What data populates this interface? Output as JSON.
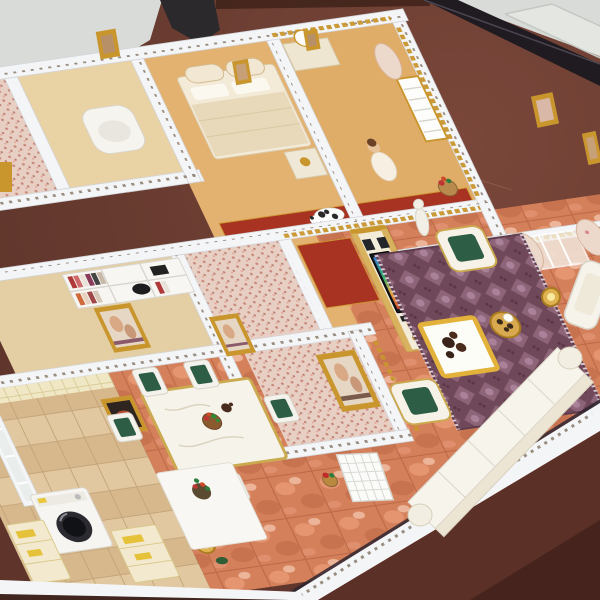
{
  "scene": {
    "subject": "Photograph of a miniature dollhouse apartment model with open-top rooms, standing on a dark reddish-brown table",
    "rooms": [
      "bathroom",
      "left-closet",
      "main-bedroom",
      "doll-bedroom",
      "study",
      "gallery-room-pink",
      "gallery-room-large-painting",
      "kitchen",
      "dining-area",
      "hallway",
      "living-room"
    ],
    "objects": [
      "dark-plaque-with-white-characters",
      "glass-pane",
      "white-walls-with-dentil-dots",
      "gold-cornice-trim",
      "bed-with-arched-headboard",
      "nightstand-with-gold-bowl",
      "dresser-with-mirror",
      "porcelain-doll-figurine",
      "toilet-fixture",
      "bookshelf-with-books",
      "black-bowl",
      "framed-classical-paintings",
      "spotted-dog-figurine",
      "red-carpet",
      "ornate-tv-wall",
      "flat-television",
      "speakers",
      "gold-plates",
      "floral-curtains",
      "french-window",
      "purple-oriental-rug",
      "gold-rimmed-coffee-table",
      "dark-tea-set",
      "white-gold-armchairs",
      "segmented-white-sofa",
      "gold-side-table",
      "gold-floor-lamps",
      "white-statue",
      "dining-table-with-carved-top",
      "green-cushion-dining-chairs",
      "fruit-bowl-centerpiece",
      "white-lattice-door",
      "red-flower-pot",
      "kitchen-counter-with-flowers",
      "washing-machine",
      "yellow-label-cabinets",
      "tile-backsplash",
      "kitchen-window",
      "white-side-chair"
    ]
  },
  "palette": {
    "sky": "#d8dbd7",
    "glass": "#eceeea",
    "table_brown": "#6e4136",
    "table_brown_dark": "#5a3027",
    "table_edge": "#1f1b21",
    "wall_white": "#f4f5f7",
    "dentil": "#8f8273",
    "gold": "#c9962e",
    "gold_deep": "#a97b1f",
    "tan_wall": "#e3b271",
    "carpet_red": "#a93322",
    "cushion_green": "#2e5d46",
    "marble": "#d4805a",
    "pink_mosaic": "#e8cfc4",
    "wood": "#dcc096",
    "rug_purple": "#6f4859"
  }
}
